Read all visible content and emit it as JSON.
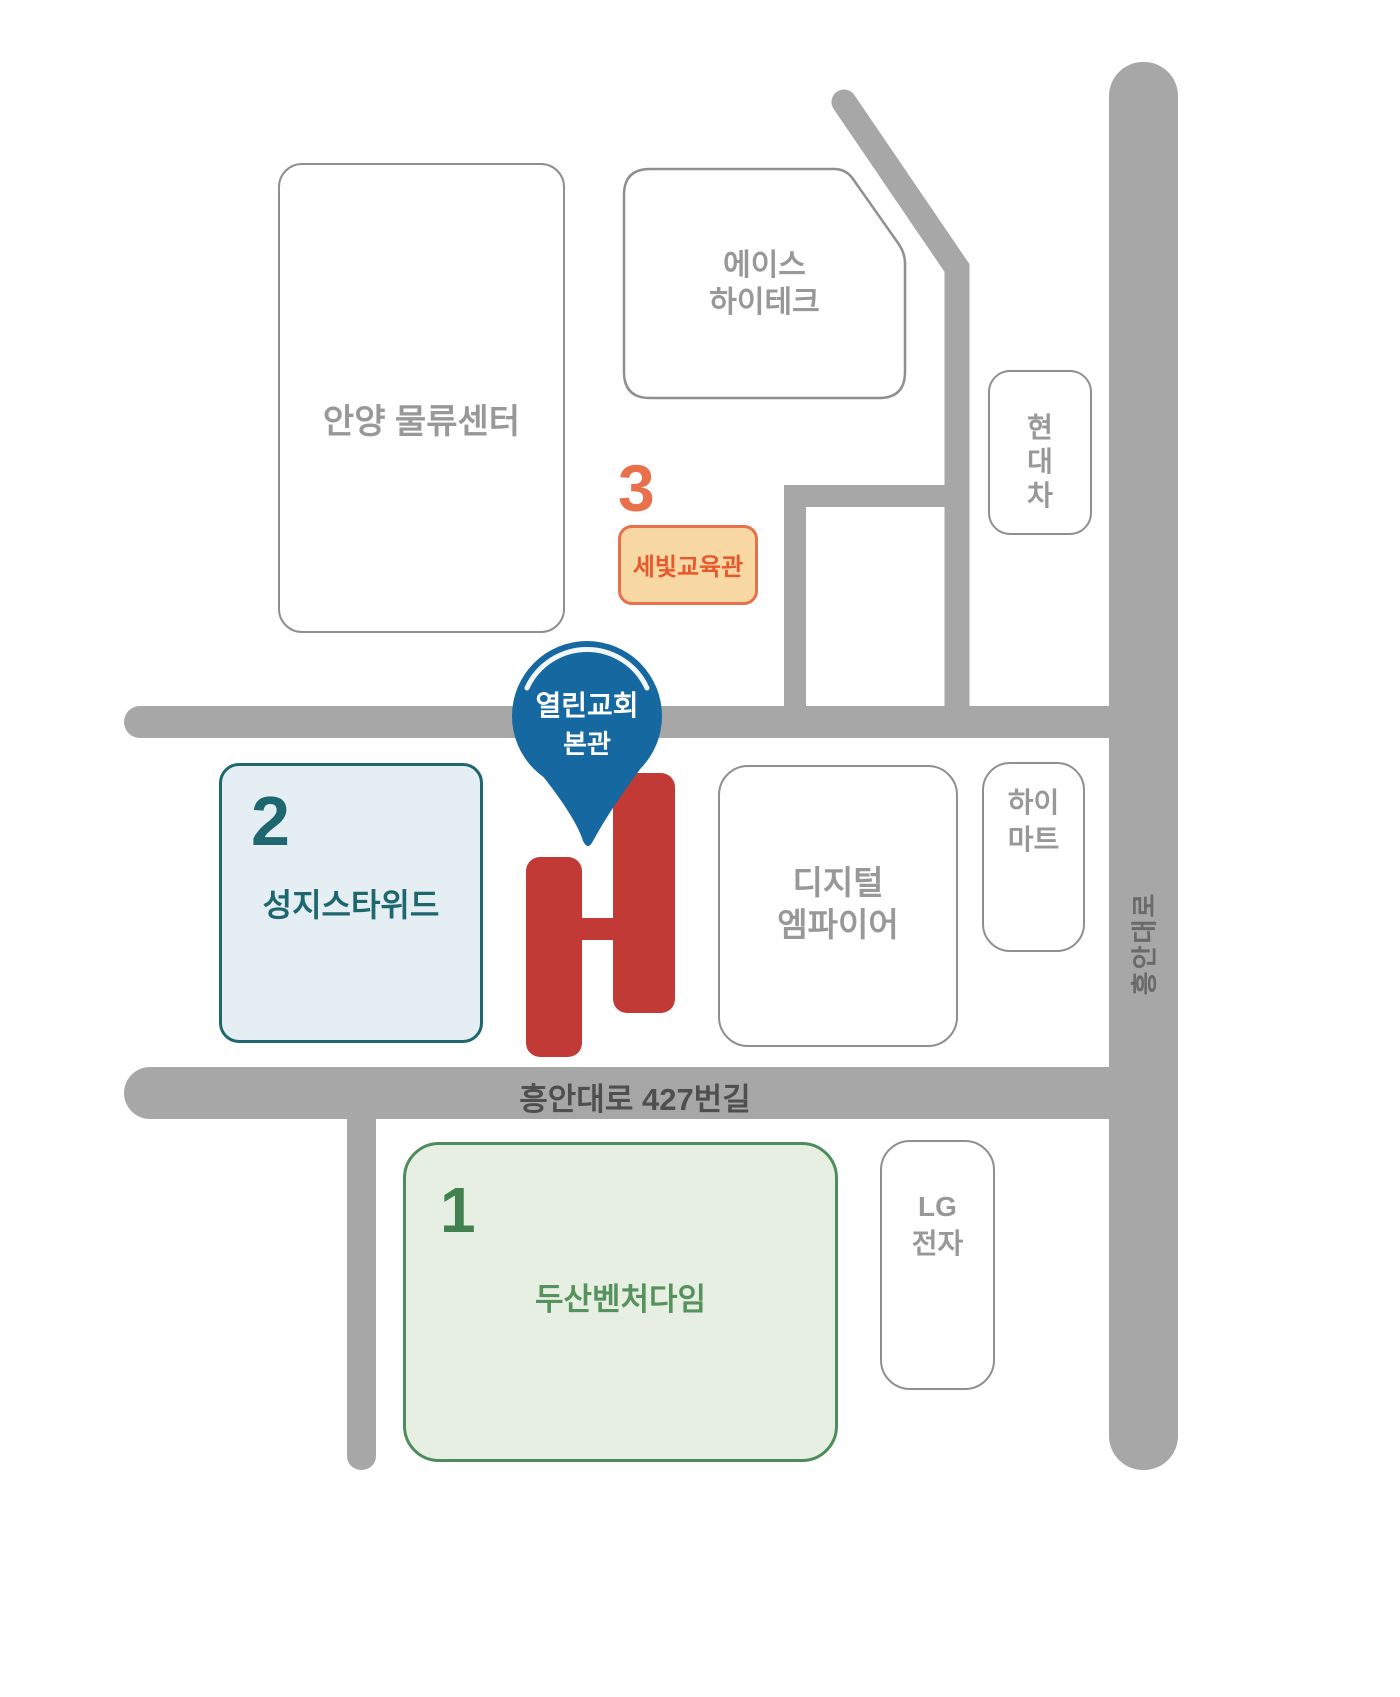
{
  "colors": {
    "road": "#a7a7a7",
    "road_text_dark": "#4f4f4f",
    "road_text_medium": "#6a6a6a",
    "building_border": "#8f8f8f",
    "building_text": "#989898",
    "teal": "#1e676e",
    "teal_fill": "#e4eef3",
    "green_border": "#4d8c5c",
    "green_text": "#55925e",
    "green_number": "#42814f",
    "green_fill": "#e7efe2",
    "orange": "#e8714c",
    "orange_text": "#e8582e",
    "peach_fill": "#f8d8a2",
    "red": "#c23a36",
    "pin_blue": "#1568a0",
    "white": "#ffffff"
  },
  "pin": {
    "line1": "열린교회",
    "line2": "본관"
  },
  "roads": {
    "bottom_road_label": "흥안대로 427번길",
    "main_road_label": "흥안대로"
  },
  "buildings": {
    "anyang": {
      "label": "안양 물류센터"
    },
    "ace": {
      "line1": "에이스",
      "line2": "하이테크"
    },
    "hyundai": {
      "line1": "현",
      "line2": "대",
      "line3": "차"
    },
    "sebit": {
      "number": "3",
      "label": "세빛교육관"
    },
    "sungji": {
      "number": "2",
      "label": "성지스타위드"
    },
    "digital": {
      "line1": "디지털",
      "line2": "엠파이어"
    },
    "himart": {
      "line1": "하이",
      "line2": "마트"
    },
    "doosan": {
      "number": "1",
      "label": "두산벤처다임"
    },
    "lg": {
      "line1": "LG",
      "line2": "전자"
    }
  }
}
